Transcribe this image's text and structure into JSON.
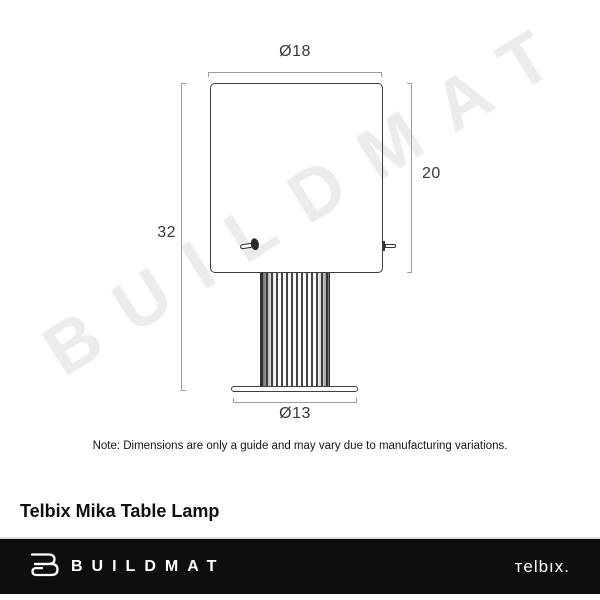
{
  "watermark": {
    "text": "BUILDMAT",
    "color": "#ececec"
  },
  "diagram": {
    "type": "product-dimension-diagram",
    "product": "table lamp line drawing (shade, fluted column, base plate, toggle switch)",
    "dimensions": {
      "shade_diameter": {
        "label": "Ø18",
        "value": 18
      },
      "shade_height": {
        "label": "20",
        "value": 20
      },
      "total_height": {
        "label": "32",
        "value": 32
      },
      "base_diameter": {
        "label": "Ø13",
        "value": 13
      }
    },
    "line_color": "#3e3e3e",
    "dimension_line_color": "#9c9c9c"
  },
  "note": "Note: Dimensions are only a guide and may vary due to manufacturing variations.",
  "title": "Telbix Mika Table Lamp",
  "footer": {
    "background": "#0e0e0e",
    "brand_text": "BUILDMAT",
    "brand_icon": "buildmat-folded-linen-icon",
    "partner_text": "тelbıx."
  }
}
